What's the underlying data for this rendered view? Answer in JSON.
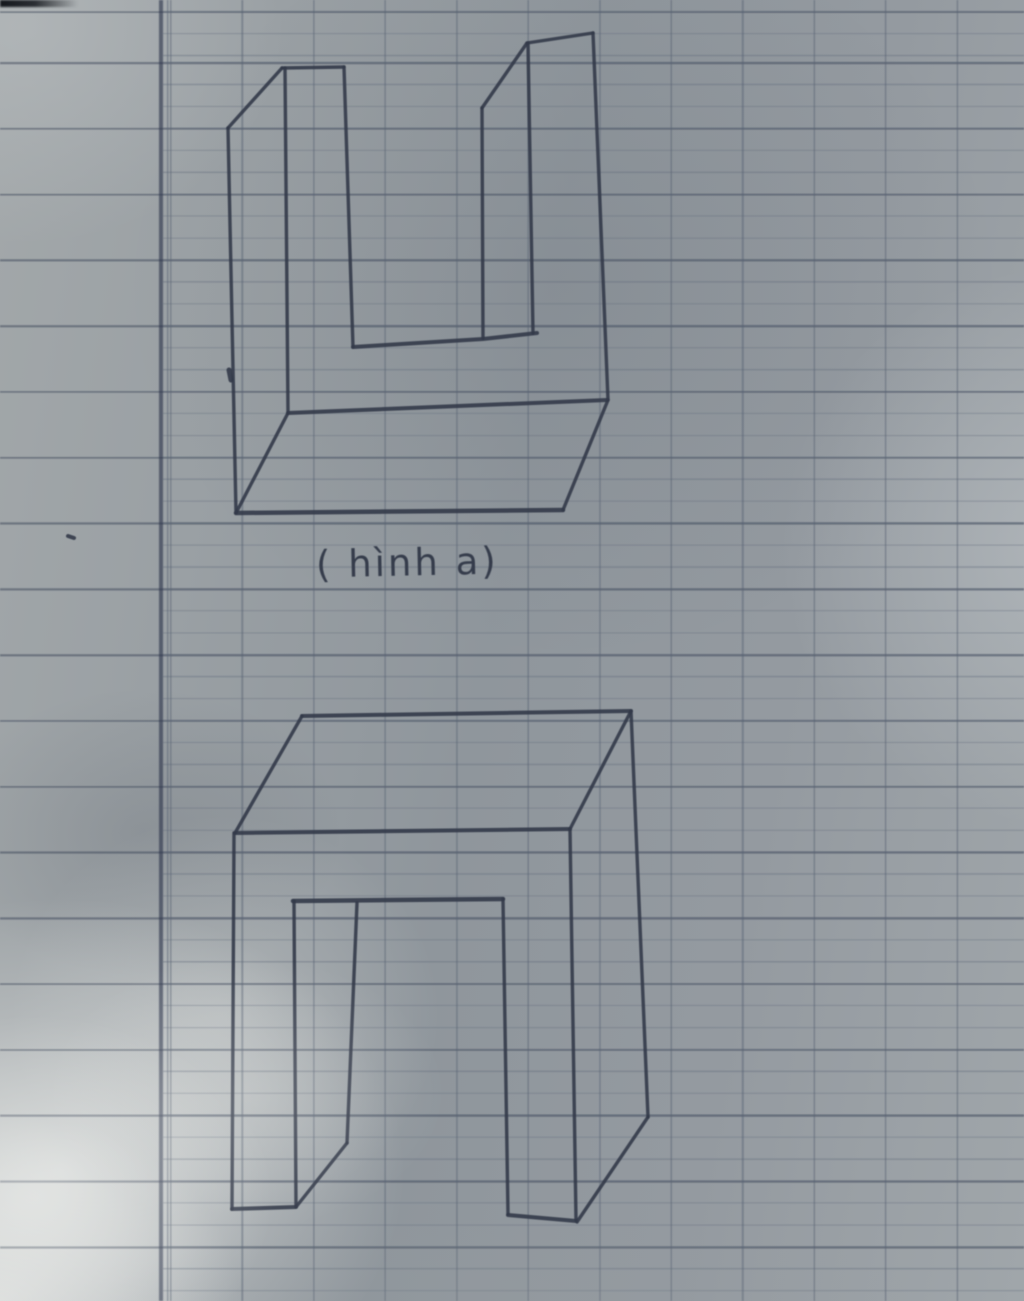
{
  "photo": {
    "pen_color": "#333a49",
    "stroke_width": 3.4,
    "paper_color": "#979da2",
    "margin_line_color": "#2c344a",
    "grid_line_color": "#58626f",
    "rule_line_color": "#3e4858"
  },
  "figures": [
    {
      "name": "u-block-sketch",
      "caption": "( hình a)",
      "strokes": [
        {
          "points": [
            [
              228,
              128
            ],
            [
              236,
              513
            ]
          ]
        },
        {
          "points": [
            [
              228,
              128
            ],
            [
              282,
              68
            ]
          ]
        },
        {
          "points": [
            [
              282,
              68
            ],
            [
              344,
              67
            ]
          ]
        },
        {
          "points": [
            [
              285,
              68
            ],
            [
              288,
              413
            ]
          ]
        },
        {
          "points": [
            [
              344,
              67
            ],
            [
              353,
              347
            ]
          ]
        },
        {
          "points": [
            [
              353,
              347
            ],
            [
              483,
              339
            ],
            [
              537,
              333
            ]
          ],
          "w": 4
        },
        {
          "points": [
            [
              482,
              108
            ],
            [
              483,
              338
            ]
          ]
        },
        {
          "points": [
            [
              482,
              108
            ],
            [
              527,
              43
            ]
          ]
        },
        {
          "points": [
            [
              527,
              43
            ],
            [
              593,
              33
            ]
          ]
        },
        {
          "points": [
            [
              528,
              43
            ],
            [
              533,
              333
            ]
          ]
        },
        {
          "points": [
            [
              593,
              33
            ],
            [
              608,
              400
            ]
          ]
        },
        {
          "points": [
            [
              288,
              413
            ],
            [
              607,
              400
            ]
          ],
          "w": 4
        },
        {
          "points": [
            [
              288,
              413
            ],
            [
              236,
              513
            ]
          ]
        },
        {
          "points": [
            [
              236,
              513
            ],
            [
              563,
              510
            ]
          ],
          "w": 4.5
        },
        {
          "points": [
            [
              608,
              400
            ],
            [
              563,
              510
            ]
          ]
        },
        {
          "points": [
            [
              229,
              370
            ],
            [
              231,
              380
            ]
          ],
          "w": 5
        }
      ]
    },
    {
      "name": "arch-block-sketch",
      "caption": "",
      "strokes": [
        {
          "points": [
            [
              302,
              716
            ],
            [
              631,
              711
            ]
          ],
          "w": 4
        },
        {
          "points": [
            [
              302,
              716
            ],
            [
              235,
              833
            ]
          ]
        },
        {
          "points": [
            [
              235,
              833
            ],
            [
              570,
              829
            ]
          ],
          "w": 4
        },
        {
          "points": [
            [
              631,
              711
            ],
            [
              570,
              829
            ]
          ]
        },
        {
          "points": [
            [
              234,
              833
            ],
            [
              232,
              1209
            ]
          ]
        },
        {
          "points": [
            [
              232,
              1209
            ],
            [
              296,
              1207
            ]
          ],
          "w": 4
        },
        {
          "points": [
            [
              294,
              901
            ],
            [
              296,
              1206
            ]
          ]
        },
        {
          "points": [
            [
              293,
              901
            ],
            [
              503,
              899
            ]
          ],
          "w": 4.5
        },
        {
          "points": [
            [
              357,
              903
            ],
            [
              347,
              1143
            ]
          ]
        },
        {
          "points": [
            [
              347,
              1143
            ],
            [
              296,
              1207
            ]
          ]
        },
        {
          "points": [
            [
              503,
              899
            ],
            [
              508,
              1214
            ]
          ]
        },
        {
          "points": [
            [
              508,
              1215
            ],
            [
              576,
              1221
            ]
          ],
          "w": 4
        },
        {
          "points": [
            [
              570,
              829
            ],
            [
              576,
              1220
            ]
          ]
        },
        {
          "points": [
            [
              631,
              711
            ],
            [
              648,
              1117
            ]
          ]
        },
        {
          "points": [
            [
              648,
              1117
            ],
            [
              577,
              1222
            ]
          ]
        }
      ]
    },
    {
      "name": "ink-smudge",
      "caption": "",
      "strokes": [
        {
          "points": [
            [
              68,
              536
            ],
            [
              74,
              538
            ]
          ],
          "w": 4,
          "o": 0.35
        }
      ]
    }
  ]
}
